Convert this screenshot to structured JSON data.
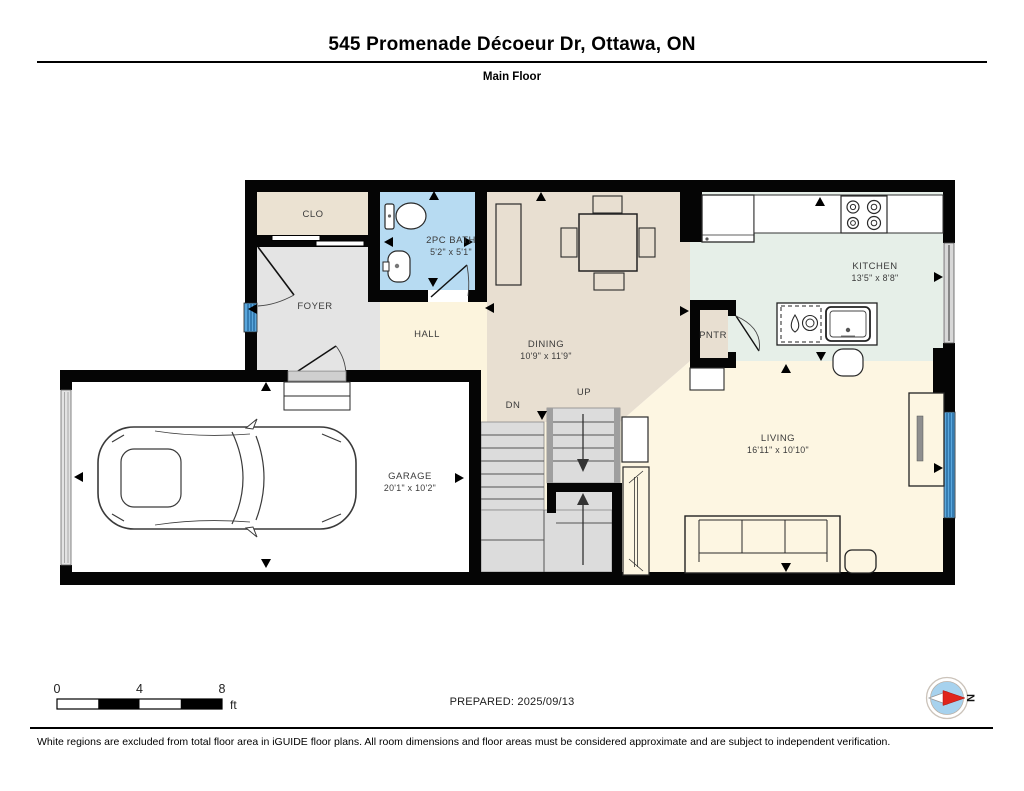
{
  "header": {
    "title": "545 Promenade Décoeur Dr, Ottawa, ON",
    "subtitle": "Main Floor"
  },
  "rooms": {
    "clo": {
      "label": "CLO"
    },
    "bath": {
      "label": "2PC BATH",
      "dims": "5'2\" x 5'1\""
    },
    "foyer": {
      "label": "FOYER"
    },
    "hall": {
      "label": "HALL"
    },
    "dining": {
      "label": "DINING",
      "dims": "10'9\" x 11'9\""
    },
    "kitchen": {
      "label": "KITCHEN",
      "dims": "13'5\" x 8'8\""
    },
    "pantry": {
      "label": "PNTR"
    },
    "garage": {
      "label": "GARAGE",
      "dims": "20'1\" x 10'2\""
    },
    "living": {
      "label": "LIVING",
      "dims": "16'11\" x 10'10\""
    },
    "stairs": {
      "up_label": "UP",
      "down_label": "DN"
    }
  },
  "scale_bar": {
    "ticks": [
      "0",
      "4",
      "8"
    ],
    "unit": "ft"
  },
  "compass": {
    "north_label": "N"
  },
  "footer": {
    "prepared": "PREPARED: 2025/09/13",
    "disclaimer": "White regions are excluded from total floor area in iGUIDE floor plans. All room dimensions and floor areas must be considered approximate and are subject to independent verification."
  },
  "colors": {
    "wall": "#050505",
    "bath_blue": "#b7dbf2",
    "dining_beige": "#e8dfd1",
    "closet_beige": "#ebe2d2",
    "foyer_gray": "#e4e4e4",
    "hall_cream": "#fcf4dd",
    "living_cream": "#fdf6e2",
    "kitchen_mint": "#e6efe8",
    "stairs_gray": "#dcdcdc",
    "window_blue": "#5aa7dc",
    "compass_blue": "#a7d2ee",
    "compass_red": "#e0251c"
  }
}
